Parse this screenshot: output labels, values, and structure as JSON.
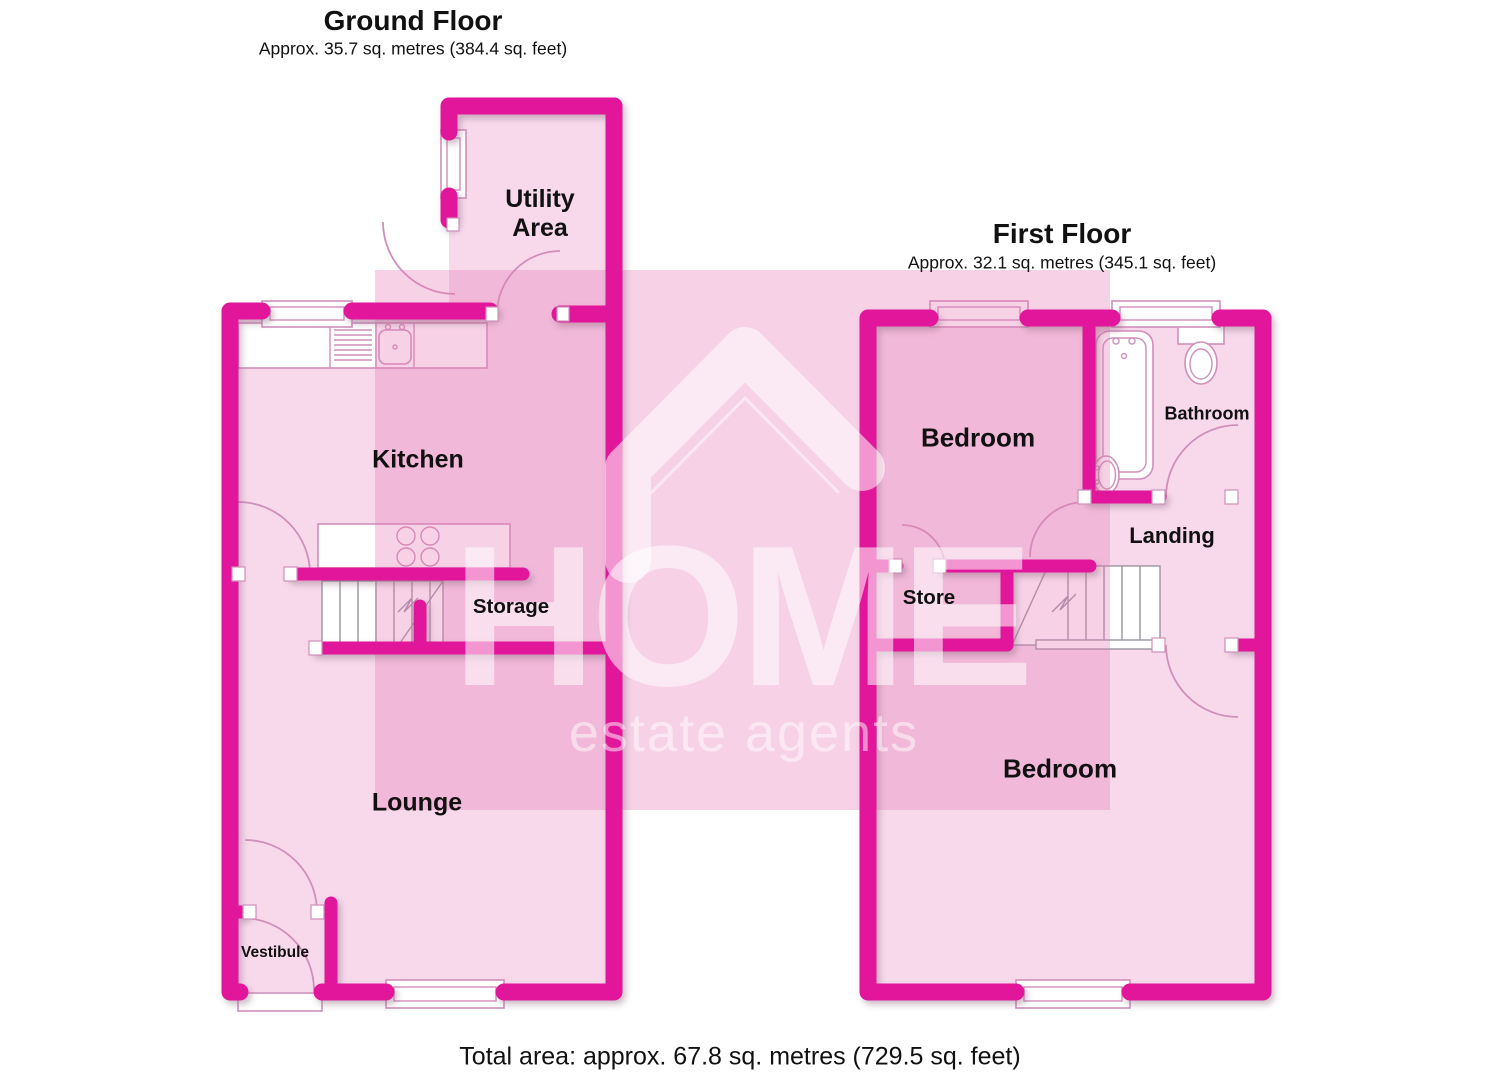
{
  "ground_floor": {
    "title": "Ground Floor",
    "subtitle": "Approx. 35.7 sq. metres (384.4 sq. feet)",
    "rooms": {
      "utility": "Utility Area",
      "kitchen": "Kitchen",
      "storage": "Storage",
      "lounge": "Lounge",
      "vestibule": "Vestibule"
    }
  },
  "first_floor": {
    "title": "First Floor",
    "subtitle": "Approx. 32.1 sq. metres (345.1 sq. feet)",
    "rooms": {
      "bedroom_front": "Bedroom",
      "bathroom": "Bathroom",
      "landing": "Landing",
      "store": "Store",
      "bedroom_rear": "Bedroom"
    }
  },
  "watermark": {
    "brand": "HOME",
    "tagline": "estate agents",
    "icon": "house-roof-icon"
  },
  "footer": {
    "total_area": "Total area: approx. 67.8 sq. metres (729.5 sq. feet)"
  },
  "colors": {
    "wall": "#e2189a",
    "room_fill": "#f8d9ec",
    "watermark_tint": "#e77bb8",
    "fixture_line": "#cf8fbb",
    "label_text": "#111111",
    "background": "#ffffff"
  }
}
